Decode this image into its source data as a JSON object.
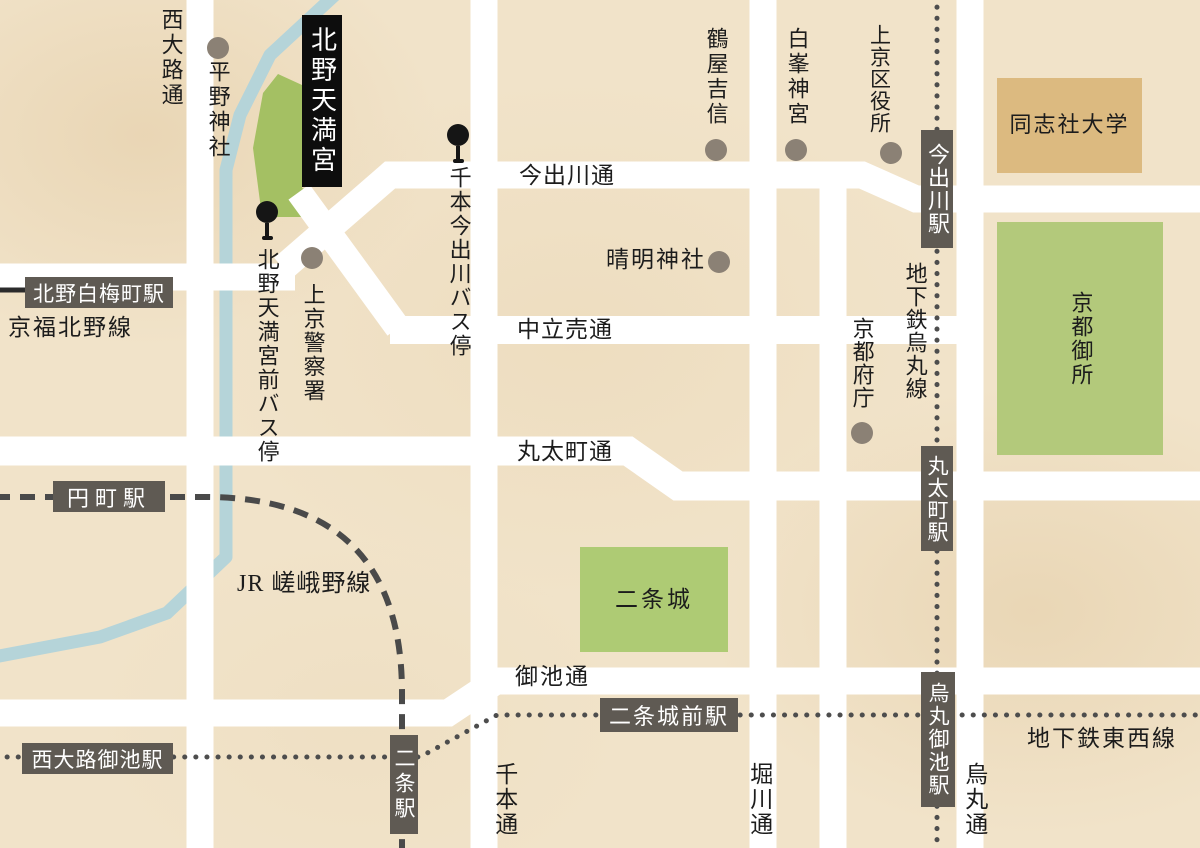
{
  "colors": {
    "background": "#f1e3c9",
    "road": "#ffffff",
    "river": "#b5d4d9",
    "park_green": "#aecb74",
    "hirano_green": "#a4c063",
    "gosho_green": "#b3c97b",
    "university_tan": "#dcba80",
    "station_box": "#5f5a53",
    "rail_line": "#4a4a4a",
    "landmark_dot": "#8b8175",
    "title_box_bg": "#0d0d0d"
  },
  "title_box": {
    "label": "北野天満宮"
  },
  "bus_stops": [
    {
      "id": "senbon-imadegawa",
      "label": "千本今出川バス停"
    },
    {
      "id": "kitano-tenmangu-mae",
      "label": "北野天満宮前バス停"
    }
  ],
  "landmarks": [
    {
      "id": "hirano-jinja",
      "label": "平野神社"
    },
    {
      "id": "tsuruya-yoshinobu",
      "label": "鶴屋吉信"
    },
    {
      "id": "shiramine-jingu",
      "label": "白峯神宮"
    },
    {
      "id": "kamigyo-ward-office",
      "label": "上京区役所"
    },
    {
      "id": "seimei-jinja",
      "label": "晴明神社"
    },
    {
      "id": "kamigyo-police-station",
      "label": "上京警察署"
    },
    {
      "id": "kyoto-pref-office",
      "label": "京都府庁"
    }
  ],
  "areas": [
    {
      "id": "doshisha-university",
      "label": "同志社大学"
    },
    {
      "id": "kyoto-gosho",
      "label": "京都御所"
    },
    {
      "id": "nijo-castle",
      "label": "二条城"
    }
  ],
  "roads": [
    {
      "id": "nishioji-dori",
      "label": "西大路通"
    },
    {
      "id": "senbon-dori",
      "label": "千本通"
    },
    {
      "id": "horikawa-dori",
      "label": "堀川通"
    },
    {
      "id": "karasuma-dori",
      "label": "烏丸通"
    },
    {
      "id": "imadegawa-dori",
      "label": "今出川通"
    },
    {
      "id": "nakadachiuri-dori",
      "label": "中立売通"
    },
    {
      "id": "marutamachi-dori",
      "label": "丸太町通"
    },
    {
      "id": "oike-dori",
      "label": "御池通"
    }
  ],
  "rail_lines": [
    {
      "id": "keifuku-kitano-line",
      "label": "京福北野線"
    },
    {
      "id": "jr-sagano-line",
      "label": "JR 嵯峨野線"
    },
    {
      "id": "subway-karasuma-line",
      "label": "地下鉄烏丸線"
    },
    {
      "id": "subway-tozai-line",
      "label": "地下鉄東西線"
    }
  ],
  "stations": [
    {
      "id": "kitano-hakubaicho",
      "label": "北野白梅町駅"
    },
    {
      "id": "emmachi",
      "label": "円町駅"
    },
    {
      "id": "nishioji-oike",
      "label": "西大路御池駅"
    },
    {
      "id": "nijo",
      "label": "二条駅"
    },
    {
      "id": "nijojo-mae",
      "label": "二条城前駅"
    },
    {
      "id": "karasuma-oike",
      "label": "烏丸御池駅"
    },
    {
      "id": "marutamachi",
      "label": "丸太町駅"
    },
    {
      "id": "imadegawa",
      "label": "今出川駅"
    }
  ]
}
